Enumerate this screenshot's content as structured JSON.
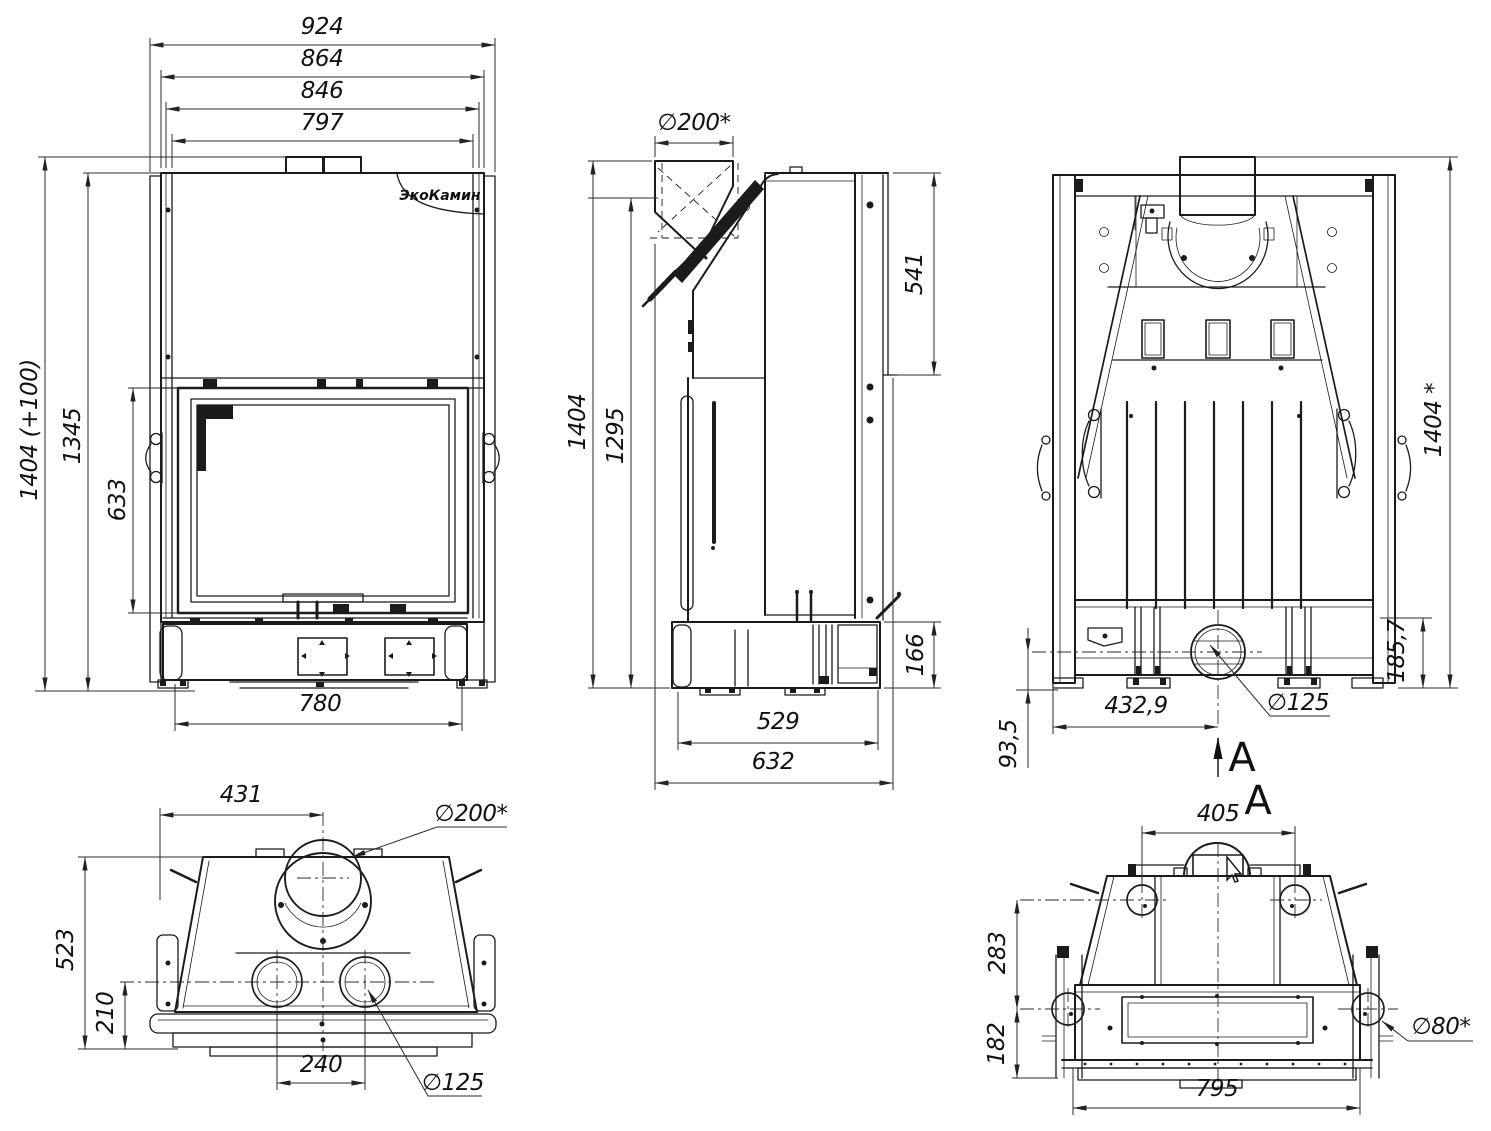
{
  "drawing": {
    "brand_logo": "ЭкоКамин",
    "front": {
      "width_total": "924",
      "width_body": "864",
      "width_casing": "846",
      "width_frame": "797",
      "height_total": "1404 (+100)",
      "height_body": "1345",
      "height_door": "633",
      "width_base": "780"
    },
    "side": {
      "flue_diameter": "∅200*",
      "rear_panel_height": "541",
      "height_total": "1404",
      "height_body": "1295",
      "base_height": "166",
      "depth_base": "529",
      "depth_total": "632"
    },
    "rear": {
      "height_total": "1404 *",
      "base_height": "185,7",
      "outlet_to_floor": "93,5",
      "outlet_offset": "432,9",
      "outlet_diameter": "∅125",
      "section_arrow": "A"
    },
    "top": {
      "flue_offset": "431",
      "flue_diameter": "∅200*",
      "depth_total": "523",
      "depth_rear": "210",
      "outlet_spacing": "240",
      "outlet_diameter": "∅125"
    },
    "section_a": {
      "title": "A",
      "width_top": "405",
      "height_upper": "283",
      "height_lower": "182",
      "hole_diameter": "∅80*",
      "width_base": "795"
    }
  }
}
